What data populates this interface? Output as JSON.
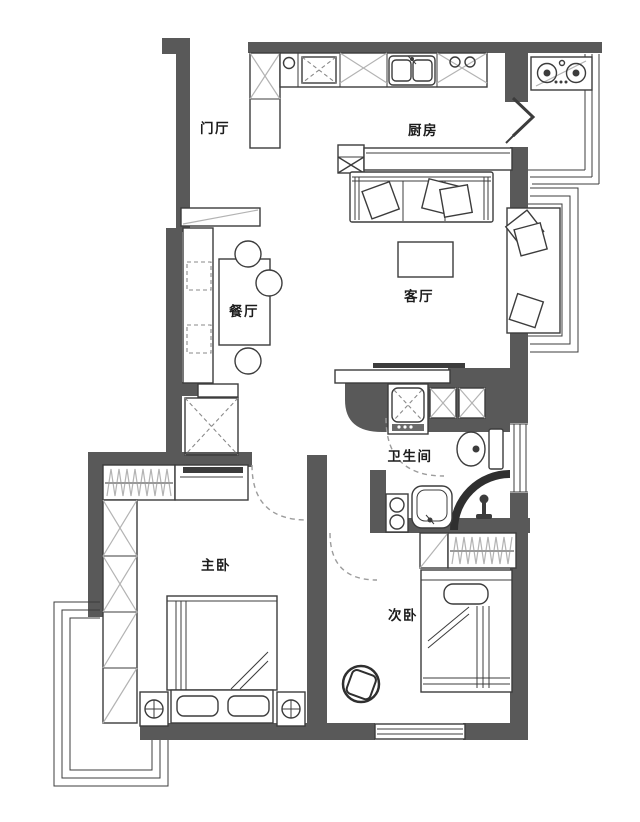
{
  "plan": {
    "type": "apartment-floor-plan",
    "rooms": [
      {
        "id": "entry-hall",
        "label": "门厅"
      },
      {
        "id": "kitchen",
        "label": "厨房"
      },
      {
        "id": "dining-room",
        "label": "餐厅"
      },
      {
        "id": "living-room",
        "label": "客厅"
      },
      {
        "id": "bathroom",
        "label": "卫生间"
      },
      {
        "id": "master-bedroom",
        "label": "主卧"
      },
      {
        "id": "second-bedroom",
        "label": "次卧"
      }
    ],
    "colors": {
      "wall": "#595959",
      "line": "#3c3c3c",
      "hatch": "#b3b3b3",
      "dash": "#9c9c9c",
      "background": "#ffffff"
    },
    "furniture_icons": [
      "shoe-cabinet",
      "kitchen-counter",
      "double-sink",
      "gas-cooktop",
      "bifold-door",
      "bar-console",
      "sofa",
      "coffee-table",
      "chaise-daybed",
      "tv",
      "tv-cabinet",
      "display-shelf",
      "dining-bench",
      "dining-table",
      "dining-chair",
      "refrigerator",
      "washing-machine",
      "storage-cabinet",
      "toilet",
      "shower",
      "wash-basin",
      "hanging-wardrobe",
      "wardrobe-column",
      "dresser",
      "double-bed",
      "nightstand",
      "table-lamp",
      "single-bed",
      "armchair",
      "bay-window",
      "door-swing"
    ]
  }
}
